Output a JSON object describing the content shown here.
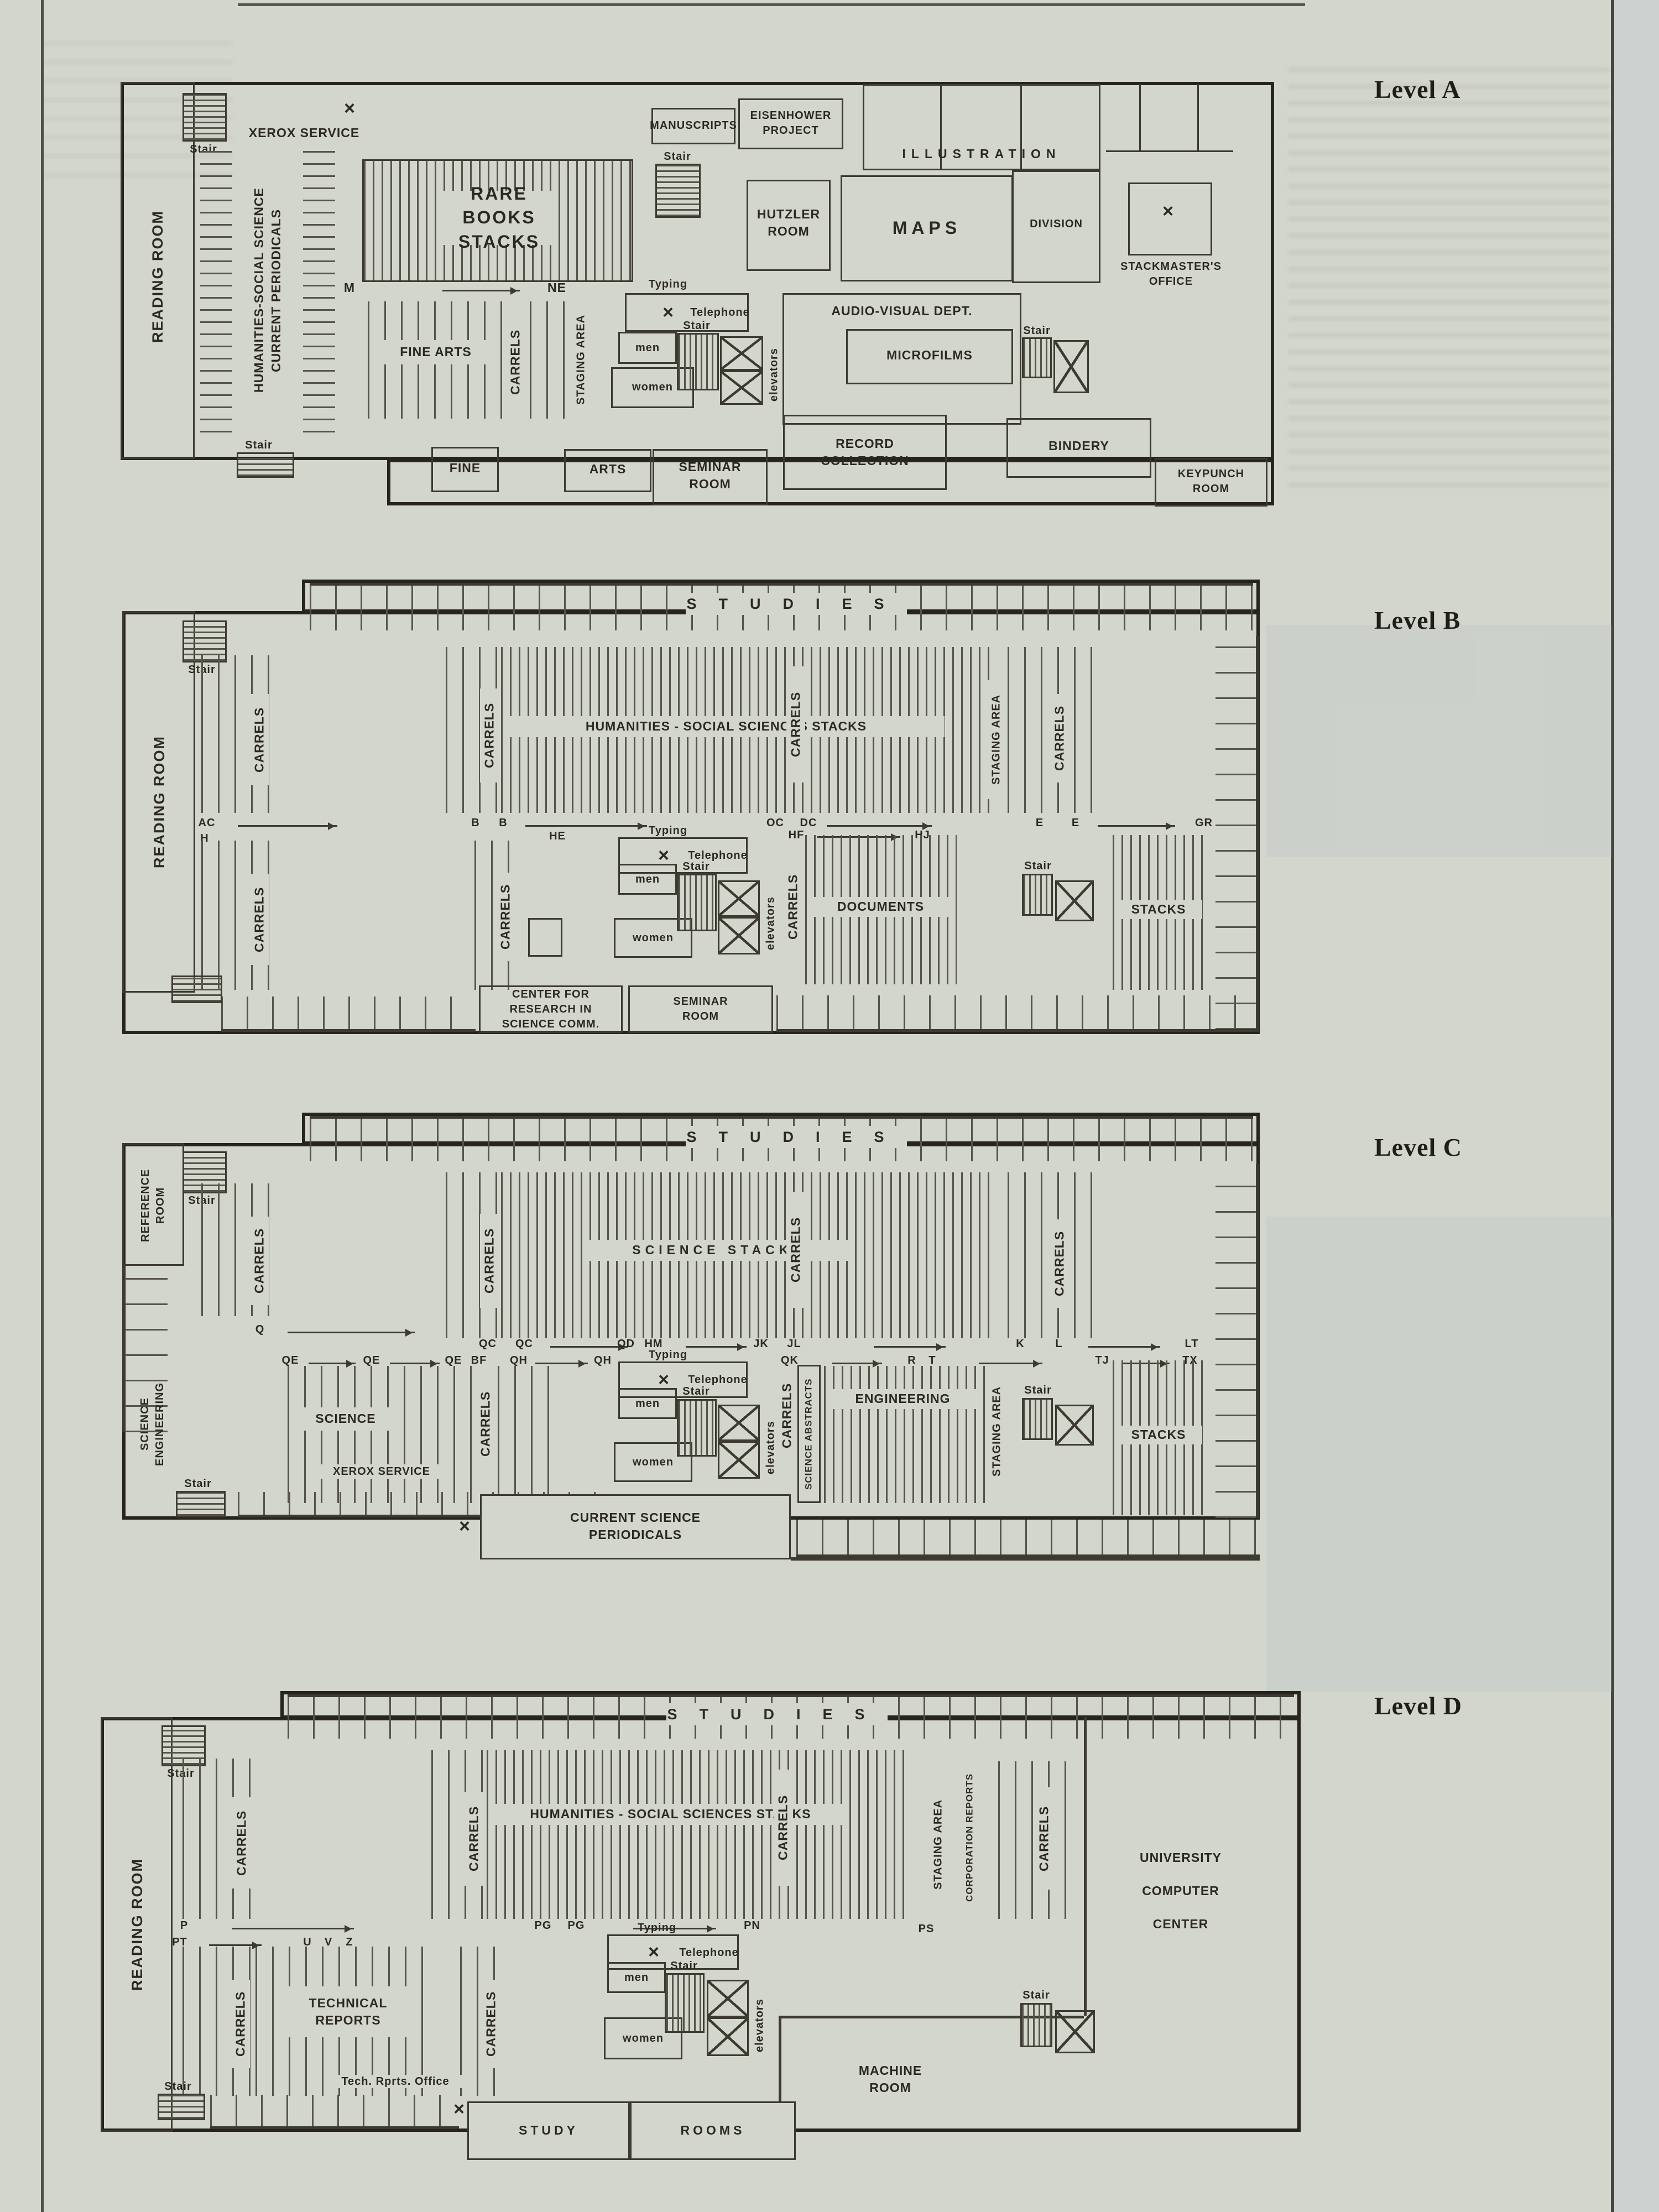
{
  "page": {
    "colors": {
      "paper": "#d3d6cc",
      "ink": "#3c3a31",
      "text": "#2b2922"
    }
  },
  "common": {
    "reading_room": "READING ROOM",
    "stair": "Stair",
    "typing": "Typing",
    "telephone": "Telephone",
    "men": "men",
    "women": "women",
    "elevators": "elevators",
    "carrels": "CARRELS",
    "staging_area": "STAGING AREA",
    "xerox": "XEROX SERVICE",
    "studies": "STUDIES",
    "x": "×",
    "seminar": "SEMINAR\nROOM",
    "stacks": "STACKS"
  },
  "levelA": {
    "title": "Level A",
    "periodicals": "HUMANITIES-SOCIAL SCIENCE\nCURRENT PERIODICALS",
    "rare_books": "RARE BOOKS\nSTACKS",
    "manuscripts": "MANUSCRIPTS",
    "eisenhower": "EISENHOWER\nPROJECT",
    "illustration": "ILLUSTRATION",
    "division": "DIVISION",
    "hutzler": "HUTZLER\nROOM",
    "maps": "MAPS",
    "stackmaster": "STACKMASTER'S\nOFFICE",
    "fine_arts": "FINE ARTS",
    "audio_visual": "AUDIO-VISUAL DEPT.",
    "microfilms": "MICROFILMS",
    "record_collection": "RECORD\nCOLLECTION",
    "bindery": "BINDERY",
    "keypunch": "KEYPUNCH\nROOM",
    "fine": "FINE",
    "arts": "ARTS",
    "codes": {
      "m": "M",
      "ne": "NE"
    }
  },
  "levelB": {
    "title": "Level B",
    "stacks_label": "HUMANITIES - SOCIAL SCIENCES STACKS",
    "documents": "DOCUMENTS",
    "center": "CENTER FOR\nRESEARCH IN\nSCIENCE COMM.",
    "codes": {
      "ac": "AC",
      "b1": "B",
      "b2": "B",
      "oc": "OC",
      "dc": "DC",
      "e1": "E",
      "e2": "E",
      "gr": "GR",
      "h": "H",
      "he": "HE",
      "hf": "HF",
      "hj": "HJ"
    }
  },
  "levelC": {
    "title": "Level C",
    "reference": "REFERENCE\nROOM",
    "sci_eng": "SCIENCE\nENGINEERING",
    "science_stacks": "SCIENCE STACKS",
    "science": "SCIENCE",
    "engineering": "ENGINEERING",
    "sci_abstracts": "SCIENCE ABSTRACTS",
    "current_sci": "CURRENT SCIENCE\nPERIODICALS",
    "codes": {
      "q": "Q",
      "qc1": "QC",
      "qc2": "QC",
      "qd": "QD",
      "hm": "HM",
      "jk": "JK",
      "jl": "JL",
      "k": "K",
      "l": "L",
      "lt": "LT",
      "qe1": "QE",
      "qe2": "QE",
      "qe3": "QE",
      "bf": "BF",
      "qh1": "QH",
      "qh2": "QH",
      "qk": "QK",
      "r": "R",
      "t": "T",
      "tj": "TJ",
      "tx": "TX"
    }
  },
  "levelD": {
    "title": "Level D",
    "stacks_label": "HUMANITIES - SOCIAL SCIENCES STACKS",
    "technical": "TECHNICAL\nREPORTS",
    "corp_reports": "CORPORATION REPORTS",
    "ucc": "UNIVERSITY\nCOMPUTER\nCENTER",
    "machine": "MACHINE\nROOM",
    "tech_office": "Tech. Rprts. Office",
    "study": "STUDY",
    "rooms": "ROOMS",
    "codes": {
      "p": "P",
      "pg1": "PG",
      "pg2": "PG",
      "pn": "PN",
      "ps": "PS",
      "pt": "PT",
      "u": "U",
      "v": "V",
      "z": "Z"
    }
  }
}
